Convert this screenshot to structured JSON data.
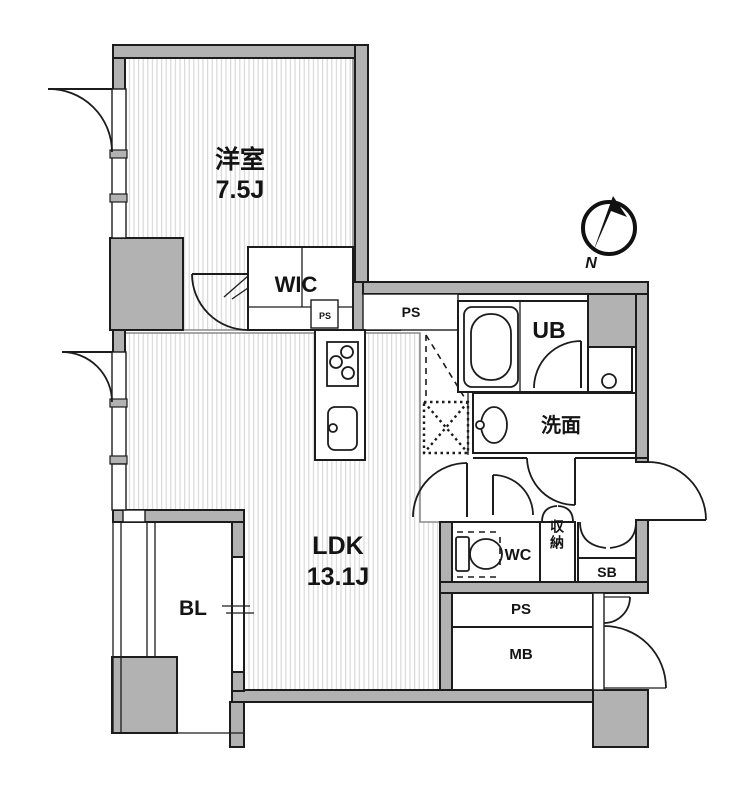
{
  "floorplan": {
    "labels": {
      "bedroom_name": "洋室",
      "bedroom_size": "7.5J",
      "wic": "WIC",
      "wic_ps": "PS",
      "ps_upper": "PS",
      "unit_bath": "UB",
      "washroom": "洗面",
      "ldk_name": "LDK",
      "ldk_size": "13.1J",
      "balcony": "BL",
      "toilet_room": "WC",
      "storage": "収納",
      "shoe_box": "SB",
      "pipe_space": "PS",
      "meter_box": "MB",
      "compass_north": "N"
    },
    "colors": {
      "wall_fill": "#b2b2b2",
      "line": "#1c1c1c",
      "floor_stripe": "#d9d9d9",
      "background": "#ffffff"
    }
  }
}
